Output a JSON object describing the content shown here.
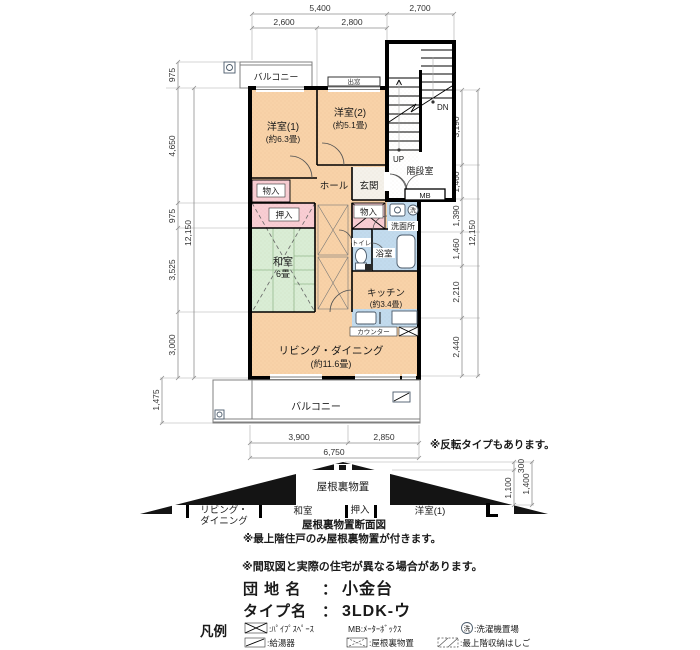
{
  "dims": {
    "top": {
      "total": "5,400",
      "stair": "2,700",
      "left": "2,600",
      "right": "2,800"
    },
    "left": {
      "s0": "975",
      "s1": "4,650",
      "s2": "975",
      "s3": "3,525",
      "s4": "3,000",
      "total": "12,150",
      "balcony": "1,475"
    },
    "right": {
      "s0": "3,190",
      "s1": "1,460",
      "s2": "1,390",
      "s3": "1,460",
      "s4": "2,210",
      "s5": "2,440",
      "total": "12,150"
    },
    "bottom": {
      "left": "3,900",
      "right": "2,850",
      "total": "6,750"
    }
  },
  "rooms": {
    "bedroom1": {
      "name": "洋室(1)",
      "size": "(約6.3畳)"
    },
    "bedroom2": {
      "name": "洋室(2)",
      "size": "(約5.1畳)"
    },
    "hall": "ホール",
    "entrance": "玄関",
    "stairwell": "階段室",
    "up": "UP",
    "dn": "DN",
    "mb": "MB",
    "storage_left": "物入",
    "storage_center": "物入",
    "oshiire": "押入",
    "washroom": "洗面所",
    "toilet": "トイレ",
    "bath": "浴室",
    "washer": "洗",
    "tatami": {
      "name": "和室",
      "size": "6畳"
    },
    "kitchen": {
      "name": "キッチン",
      "size": "(約3.4畳)"
    },
    "counter": "カウンター",
    "living": {
      "name": "リビング・ダイニング",
      "size": "(約11.6畳)"
    },
    "balcony_top": "バルコニー",
    "balcony_bottom": "バルコニー",
    "bay_window": "出窓"
  },
  "roof": {
    "attic": "屋根裏物置",
    "caption": "屋根裏物置断面図",
    "labels": {
      "living1": "リビング・",
      "living2": "ダイニング",
      "tatami": "和室",
      "oshiire": "押入",
      "bedroom1": "洋室(1)"
    },
    "dims": {
      "top": "300",
      "mid": "1,100",
      "total": "1,400"
    }
  },
  "notes": {
    "reverse": "※反転タイプもあります。",
    "attic_note": "※最上階住戸のみ屋根裏物置が付きます。",
    "disclaimer": "※間取図と実際の住宅が異なる場合があります。"
  },
  "info": {
    "estate_label": "団 地 名",
    "estate_sep": "：",
    "estate_value": "小金台",
    "type_label": "タイプ名",
    "type_sep": "：",
    "type_value": "3LDK-ウ"
  },
  "legend": {
    "title": "凡例",
    "pipe_space": ":ﾊﾟｲﾌﾟｽﾍﾟｰｽ",
    "meter_box": "MB:ﾒｰﾀｰﾎﾞｯｸｽ",
    "washer_char": "洗",
    "washer_place": ":洗濯機置場",
    "water_heater": ":給湯器",
    "attic_storage": ":屋根裏物置",
    "ladder": ":最上階収納はしご"
  },
  "colors": {
    "room": "#f8d2a8",
    "tatami": "#d9edd5",
    "closet": "#f8cdd3",
    "water": "#c2dbee",
    "wall": "#000000",
    "entry": "#f4f1ea"
  }
}
